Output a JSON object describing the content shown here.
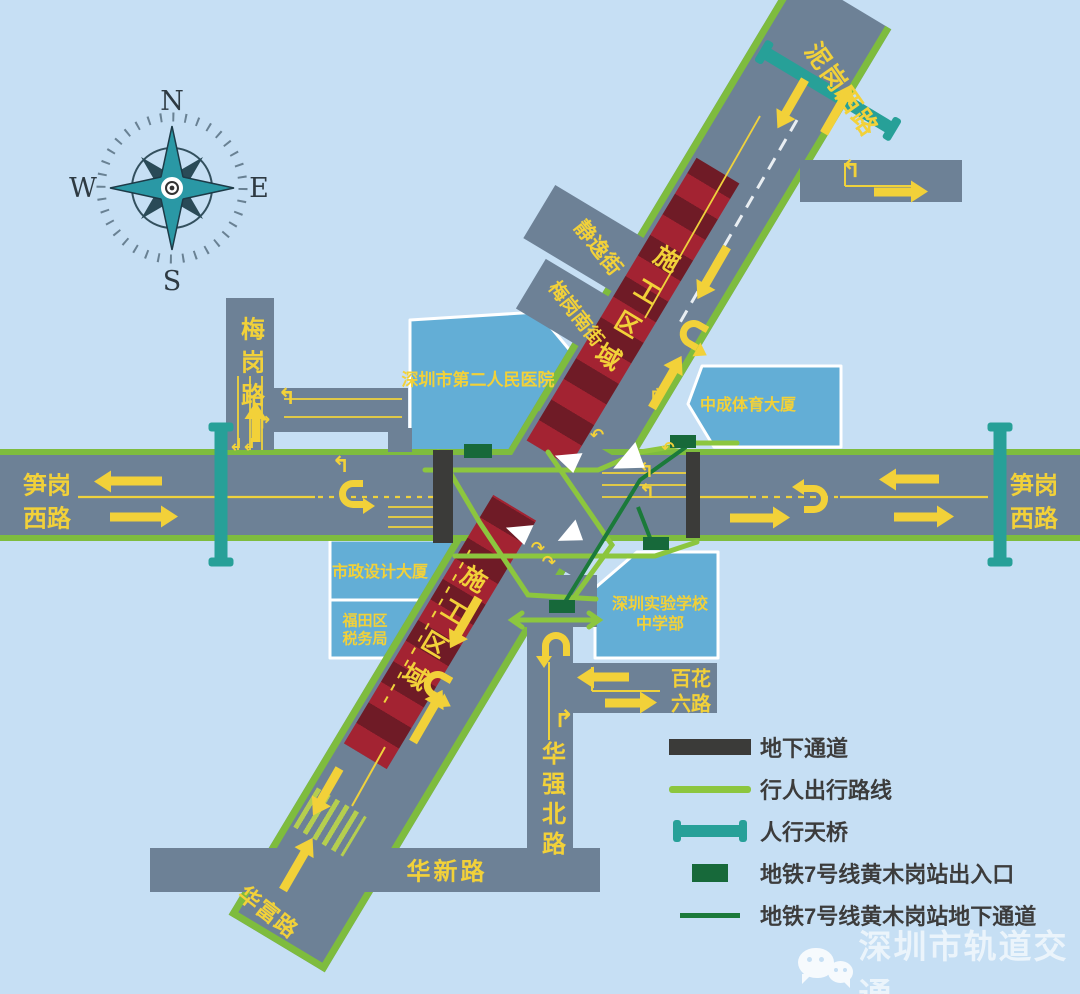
{
  "colors": {
    "background": "#c6dff4",
    "road_gray": "#6d8196",
    "road_edge_green": "#7ebc3e",
    "pedestrian_route_green": "#8cc63e",
    "building_blue": "#63aed6",
    "building_border": "#ffffff",
    "label_yellow": "#f2d139",
    "construction_red": "#a32332",
    "construction_red_dark": "#6f1b26",
    "underground_passage_dark": "#3b3b39",
    "footbridge_teal": "#27a098",
    "metro_entrance_green": "#17693a",
    "metro_passage_green": "#1b7a3a",
    "legend_text": "#3c3c3c",
    "watermark_white": "rgba(255,255,255,0.78)"
  },
  "compass": {
    "north": "N",
    "east": "E",
    "south": "S",
    "west": "W"
  },
  "roads": {
    "nigang_xi": "泥岗西路",
    "sungang_xi_left_l1": "笋岗",
    "sungang_xi_left_l2": "西路",
    "sungang_xi_right_l1": "笋岗",
    "sungang_xi_right_l2": "西路",
    "meigang": "梅岗路",
    "jingyi_jie": "静逸街",
    "meigang_nan_jie": "梅岗南街",
    "huaqiang_bei": "华强北路",
    "baihua_liu_l1": "百花",
    "baihua_liu_l2": "六路",
    "huaxin": "华新路",
    "huafu": "华富路"
  },
  "buildings": {
    "hospital": "深圳市第二人民医院",
    "zhongcheng_sports": "中成体育大厦",
    "municipal_design": "市政设计大厦",
    "futian_tax_l1": "福田区",
    "futian_tax_l2": "税务局",
    "experimental_school_l1": "深圳实验学校",
    "experimental_school_l2": "中学部"
  },
  "construction": {
    "upper_zone_label": "施工区域",
    "lower_zone_label": "施工区域"
  },
  "legend": {
    "items": [
      {
        "icon": "underground-passage-icon",
        "label": "地下通道"
      },
      {
        "icon": "pedestrian-route-icon",
        "label": "行人出行路线"
      },
      {
        "icon": "footbridge-icon",
        "label": "人行天桥"
      },
      {
        "icon": "metro-entrance-icon",
        "label": "地铁7号线黄木岗站出入口"
      },
      {
        "icon": "metro-underground-passage-icon",
        "label": "地铁7号线黄木岗站地下通道"
      }
    ]
  },
  "watermark": {
    "text": "深圳市轨道交通"
  }
}
